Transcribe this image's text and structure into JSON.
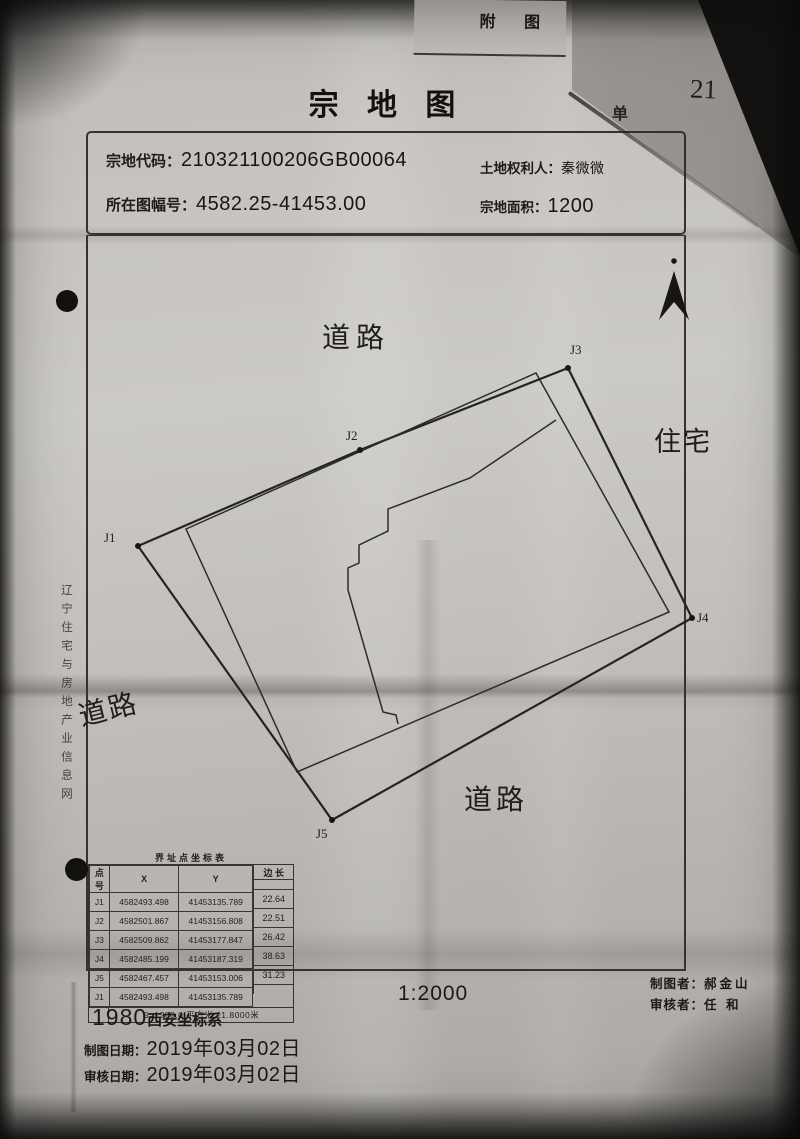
{
  "meta": {
    "attachment_label": "附 图",
    "page_number": "21",
    "partial_unit_label": "单"
  },
  "title": "宗 地 图",
  "header": {
    "parcel_code_label": "宗地代码：",
    "parcel_code": "210321100206GB00064",
    "holder_label": "土地权利人：",
    "holder": "秦微微",
    "sheet_no_label": "所在图幅号：",
    "sheet_no": "4582.25-41453.00",
    "area_label": "宗地面积：",
    "area": "1200"
  },
  "map": {
    "labels": {
      "road_top": "道路",
      "road_left": "道路",
      "road_bottom": "道路",
      "residence": "住宅"
    },
    "point_labels": {
      "j1": "J1",
      "j2": "J2",
      "j3": "J3",
      "j4": "J4",
      "j5": "J5"
    },
    "north_arrow": "north-arrow"
  },
  "table": {
    "title": "界址点坐标表",
    "headers": [
      "点 号",
      "X",
      "Y",
      "边 长"
    ],
    "rows": [
      [
        "J1",
        "4582493.498",
        "41453135.789"
      ],
      [
        "J2",
        "4582501.867",
        "41453156.808"
      ],
      [
        "J3",
        "4582509.862",
        "41453177.847"
      ],
      [
        "J4",
        "4582485.199",
        "41453187.319"
      ],
      [
        "J5",
        "4582467.457",
        "41453153.006"
      ],
      [
        "J1",
        "4582493.498",
        "41453135.789"
      ]
    ],
    "edge_lengths": [
      "22.64",
      "22.51",
      "26.42",
      "38.63",
      "31.23"
    ],
    "footer": "S=1200.0 平方米 ±1.8000米"
  },
  "footer": {
    "coord_system_year": "1980",
    "coord_system_name": "西安坐标系",
    "scale": "1:2000",
    "made_date_label": "制图日期：",
    "made_date": "2019年03月02日",
    "review_date_label": "审核日期：",
    "review_date": "2019年03月02日",
    "maker_label": "制图者：",
    "maker": "郝金山",
    "reviewer_label": "审核者：",
    "reviewer": "任 和"
  },
  "watermark": {
    "vertical_text": "辽宁住宅与房地产业信息网"
  },
  "colors": {
    "paper": "#c7c4c0",
    "ink": "#1d1b18",
    "photo_bg": "#3a3836",
    "line": "#36332f"
  }
}
